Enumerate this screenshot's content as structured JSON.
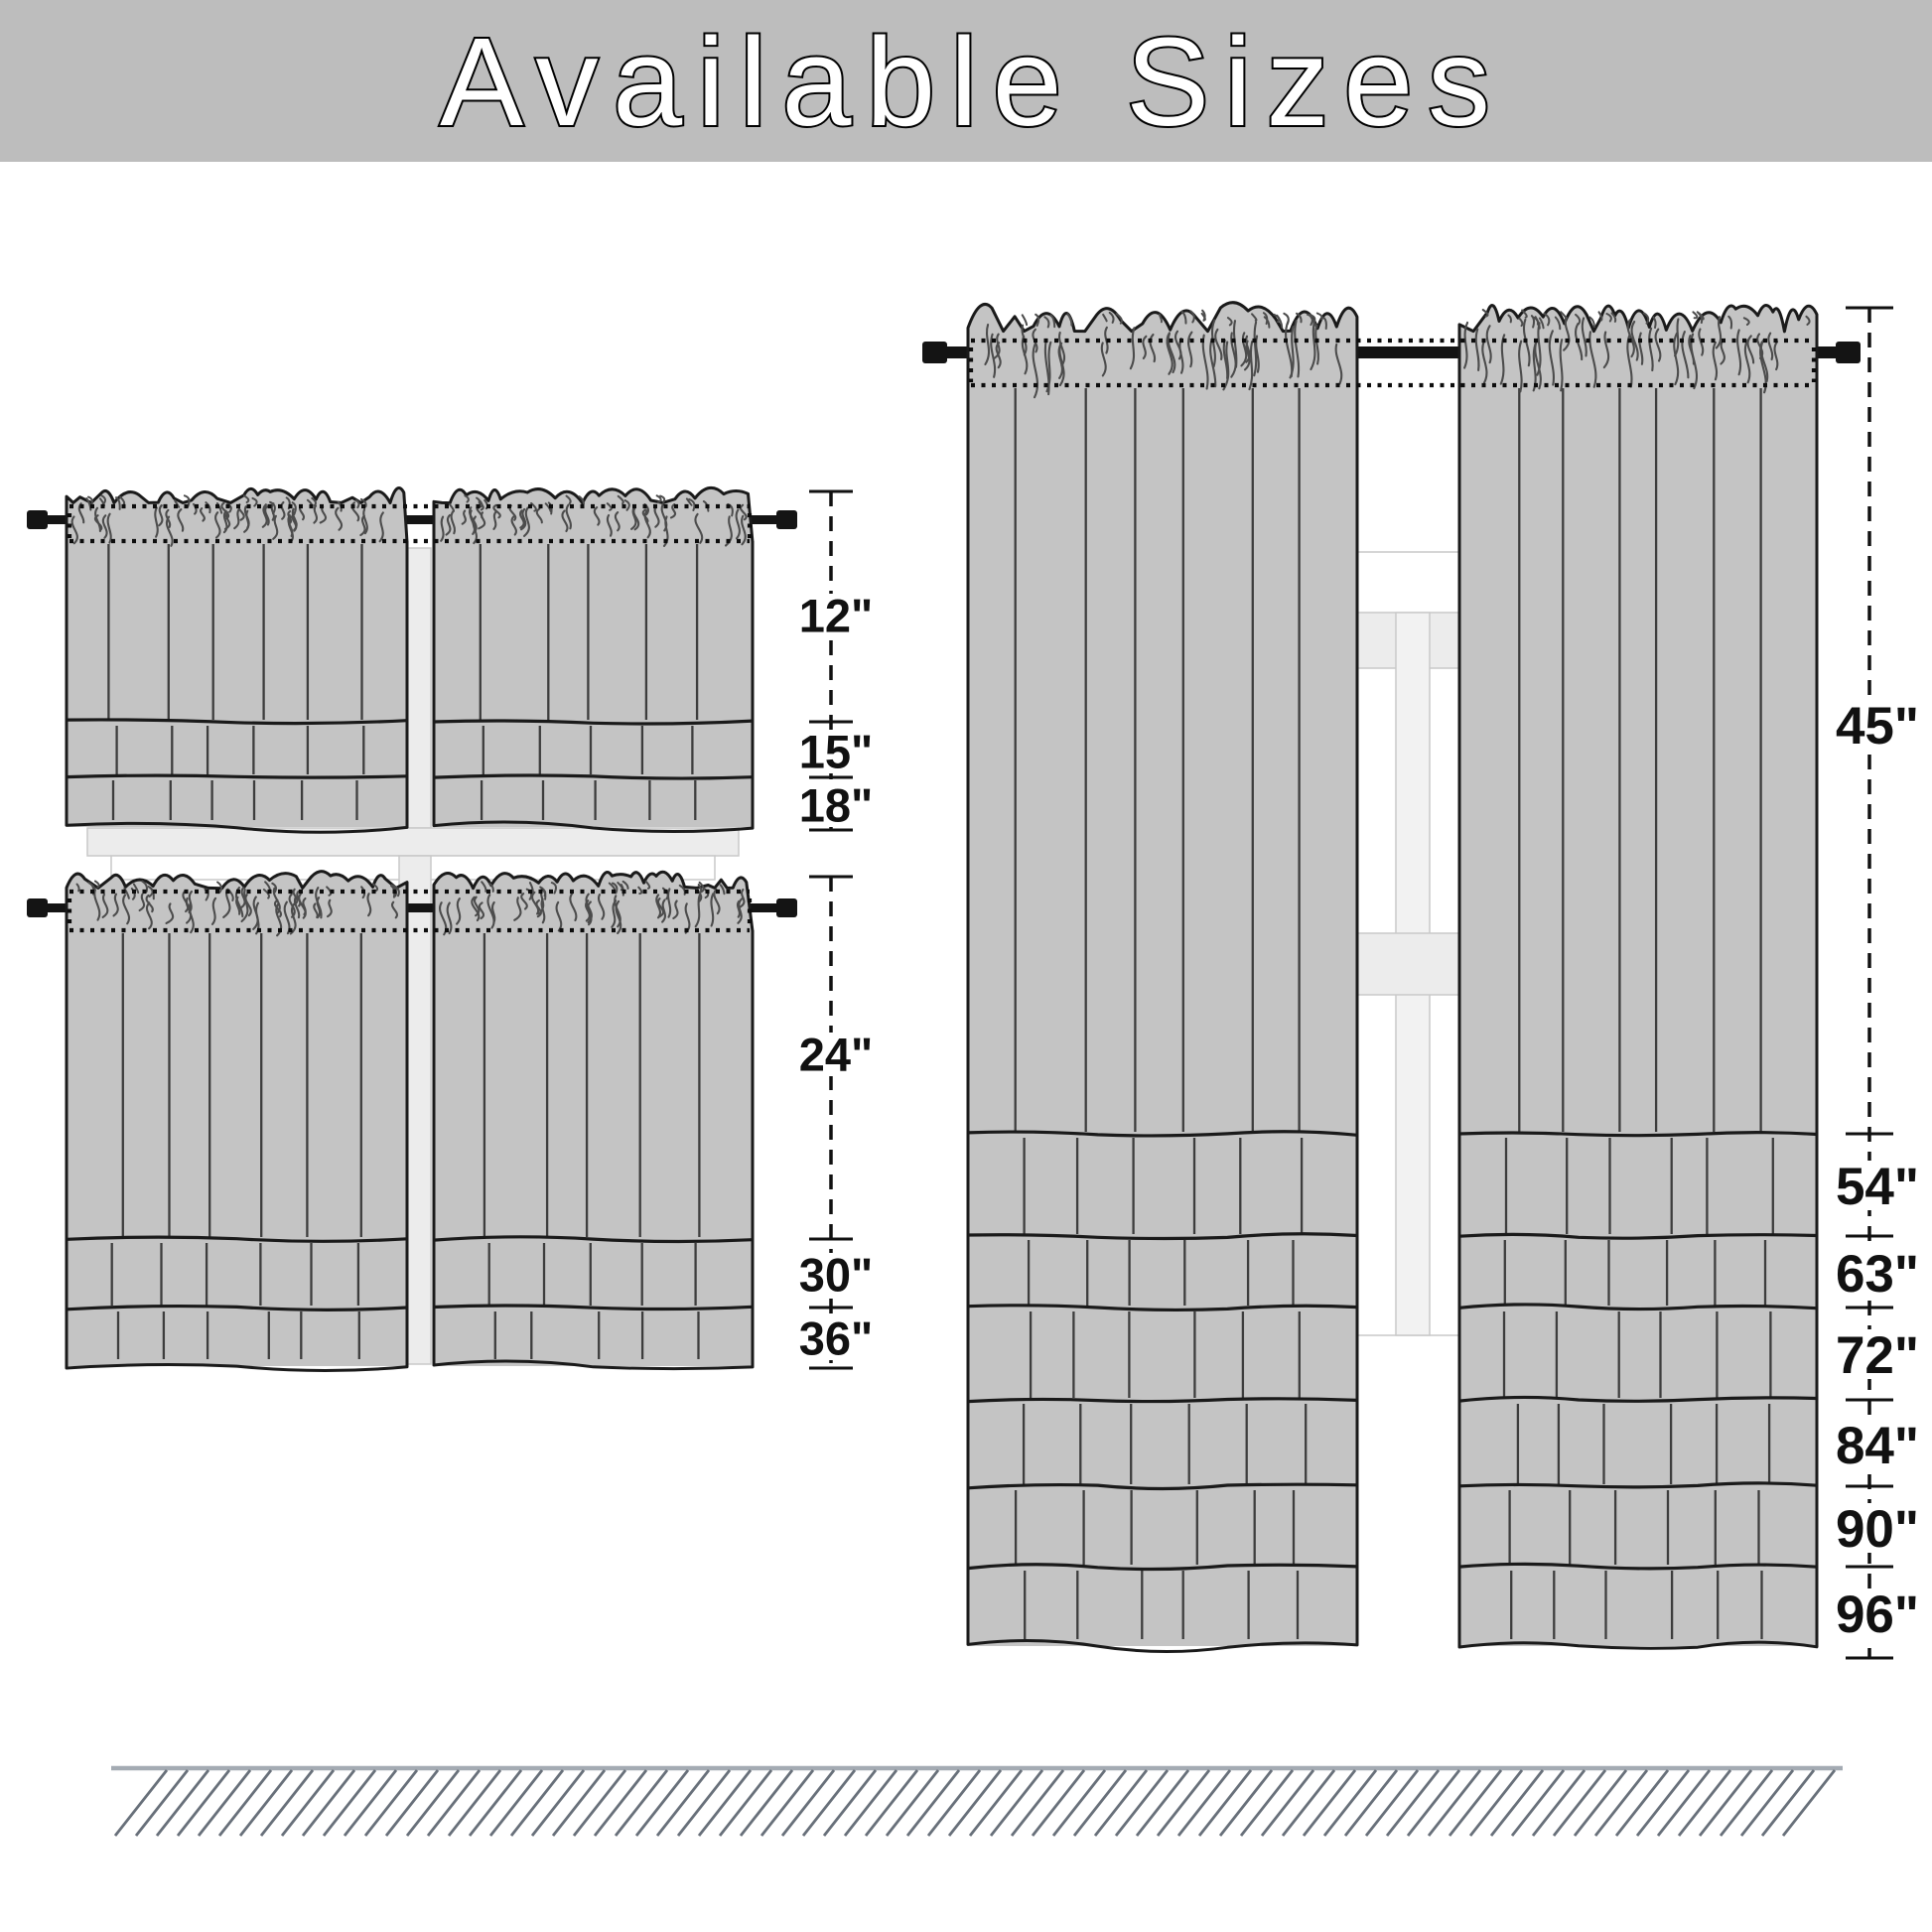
{
  "title": "Available Sizes",
  "measurements": {
    "left_top": {
      "sizes": [
        "12\"",
        "15\"",
        "18\""
      ]
    },
    "left_bottom": {
      "sizes": [
        "24\"",
        "30\"",
        "36\""
      ]
    },
    "right": {
      "sizes": [
        "45\"",
        "54\"",
        "63\"",
        "72\"",
        "84\"",
        "90\"",
        "96\""
      ]
    }
  },
  "colors": {
    "banner": "#bdbdbd",
    "title_fill": "#ffffff",
    "title_stroke": "#000000",
    "curtain": "#c4c4c4",
    "outline": "#1a1a1a",
    "fold": "#3d3d3d",
    "squiggle": "#4c4c4c",
    "rod": "#141414",
    "dotted": "#0d0d0d",
    "window_bar": "#ececec",
    "window_edge": "#c9c9c9",
    "measure": "#111111",
    "floor_line": "#a4abb3",
    "floor_hatch": "#68707a"
  }
}
